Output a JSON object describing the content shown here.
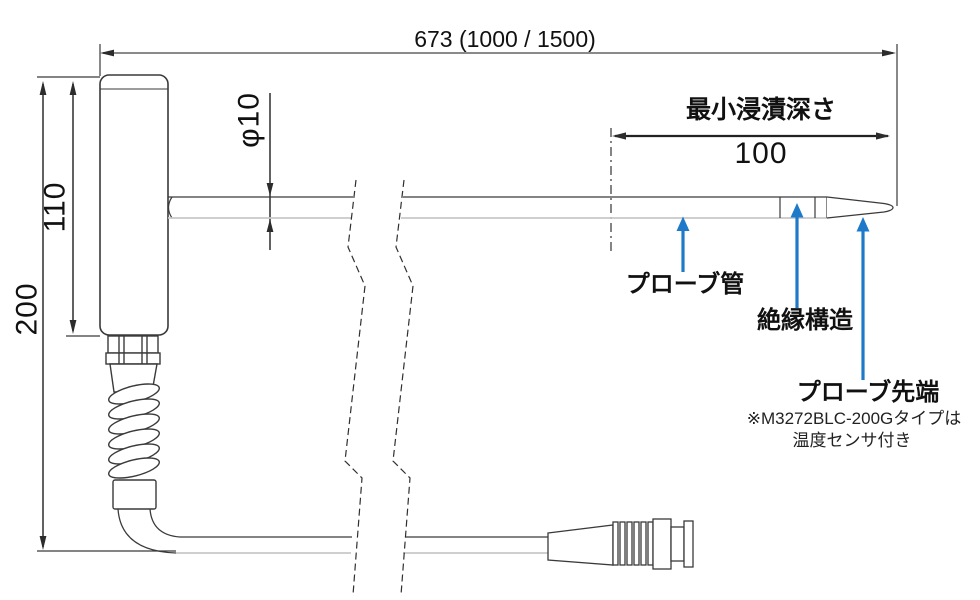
{
  "diagram": {
    "dimensions": {
      "overall_length": "673 (1000 / 1500)",
      "immersion_depth_label": "最小浸漬深さ",
      "immersion_depth_value": "100",
      "handle_length": "110",
      "total_height": "200",
      "tube_diameter": "φ10"
    },
    "annotations": {
      "probe_tube": "プローブ管",
      "insulation": "絶縁構造",
      "probe_tip": "プローブ先端",
      "probe_tip_note_line1": "※M3272BLC-200Gタイプは",
      "probe_tip_note_line2": "温度センサ付き"
    },
    "colors": {
      "annotation_arrow": "#1e7ac9",
      "line_dark": "#3a3a3a",
      "line_light": "#c8c8c8",
      "dim_line_gray": "#8a8a8a"
    }
  }
}
